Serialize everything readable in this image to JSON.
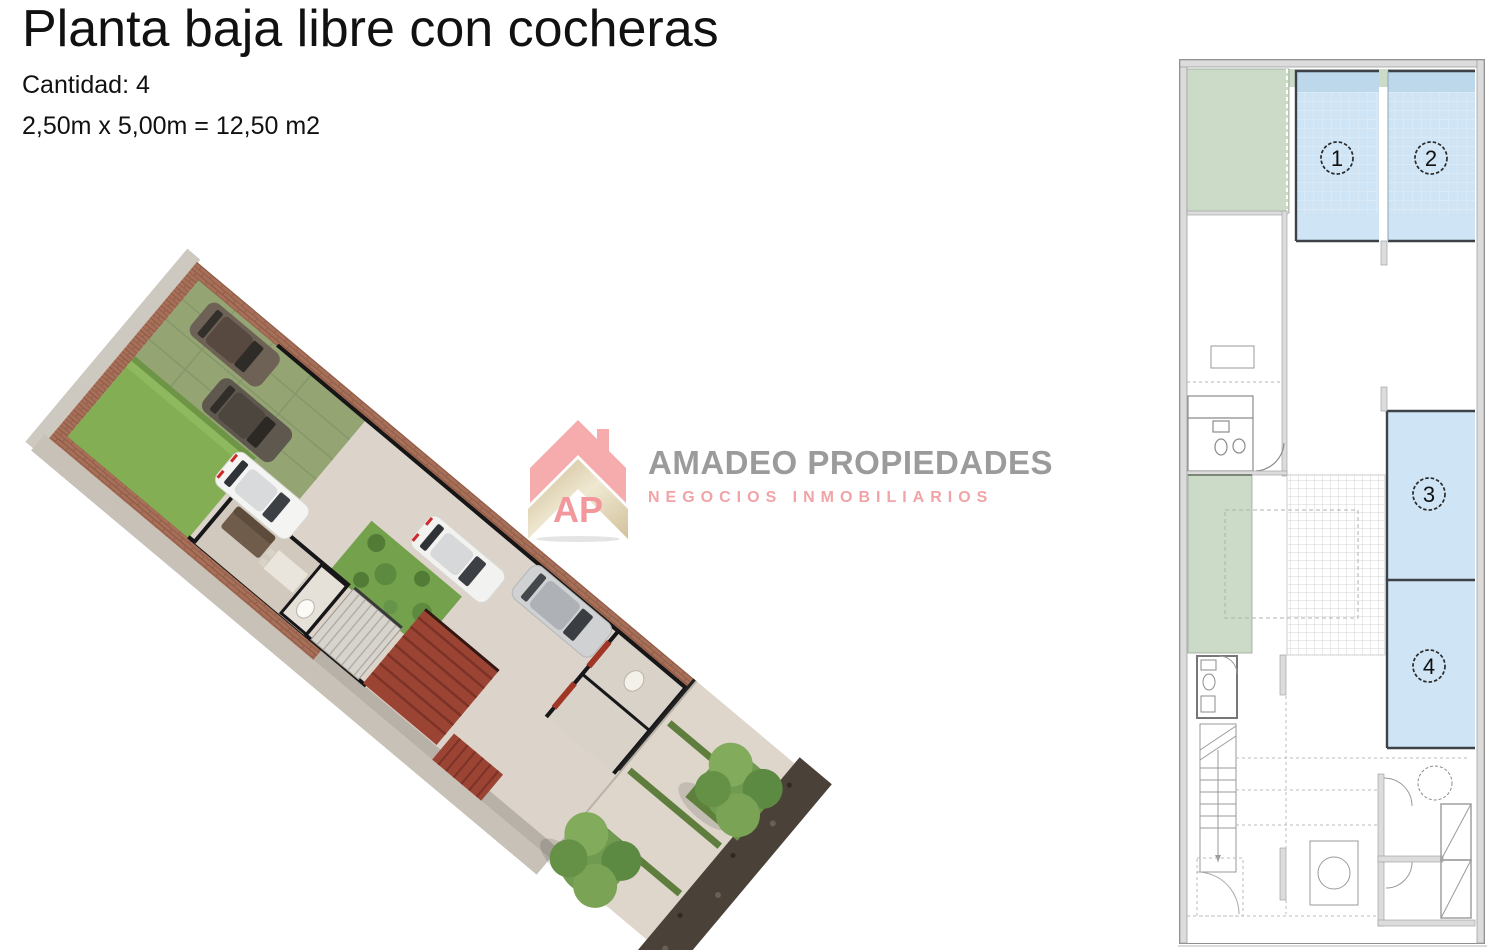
{
  "header": {
    "title": "Planta baja libre con cocheras",
    "quantity": "Cantidad: 4",
    "dimensions": "2,50m x 5,00m = 12,50 m2"
  },
  "watermark": {
    "monogram": "AP",
    "brand": "AMADEO PROPIEDADES",
    "tagline": "NEGOCIOS INMOBILIARIOS",
    "colors": {
      "brand_text": "#9b9b9b",
      "tagline_text": "#f2a3a6",
      "roof_pink": "#f6abad",
      "chevron_beige": "#d9c9a4"
    }
  },
  "floorplan": {
    "parking": [
      {
        "label": "1"
      },
      {
        "label": "2"
      },
      {
        "label": "3"
      },
      {
        "label": "4"
      }
    ],
    "colors": {
      "parking_fill": "#cfe4f4",
      "parking_top_band": "#bdd8ea",
      "green_area": "#ccdbc8",
      "wall_fill": "#dcdcdc",
      "wall_edge": "#9a9a9a",
      "outline_dark": "#3c4247"
    }
  },
  "render": {
    "colors": {
      "brick": "#a87058",
      "lawn": "#82ad52",
      "floor": "#dcd4ca",
      "red_structure": "#9c4434",
      "tree_green": "#6f9a4f",
      "soil": "#4a4138"
    }
  }
}
